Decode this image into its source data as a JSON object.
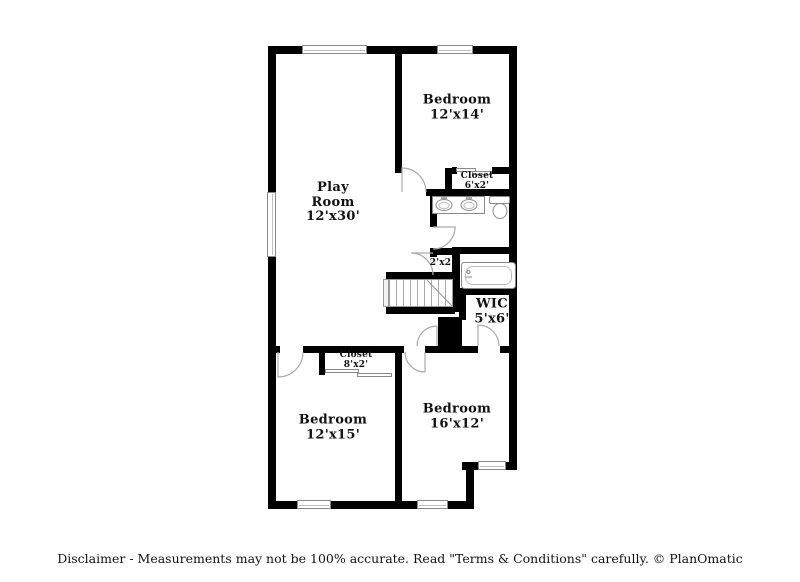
{
  "rooms": {
    "play_room": {
      "name": "Play Room",
      "dims": "12'x30'"
    },
    "bedroom_top": {
      "name": "Bedroom",
      "dims": "12'x14'"
    },
    "closet_top": {
      "name": "Closet",
      "dims": "6'x2'"
    },
    "closet_small": {
      "dims": "2'x2'"
    },
    "wic": {
      "name": "WIC",
      "dims": "5'x6'"
    },
    "closet_bottom": {
      "name": "Closet",
      "dims": "8'x2'"
    },
    "bedroom_left": {
      "name": "Bedroom",
      "dims": "12'x15'"
    },
    "bedroom_right": {
      "name": "Bedroom",
      "dims": "16'x12'"
    }
  },
  "fixtures": [
    "stairs",
    "bathtub",
    "toilet",
    "double-sink-vanity",
    "chimney-chase"
  ],
  "footer": {
    "disclaimer": "Disclaimer - Measurements may not be 100% accurate. Read \"Terms & Conditions\" carefully. © PlanOmatic"
  },
  "colors": {
    "wall": "#000000",
    "label_text": "#121212",
    "fixture_outline": "#8a8a8a",
    "background": "#ffffff"
  }
}
